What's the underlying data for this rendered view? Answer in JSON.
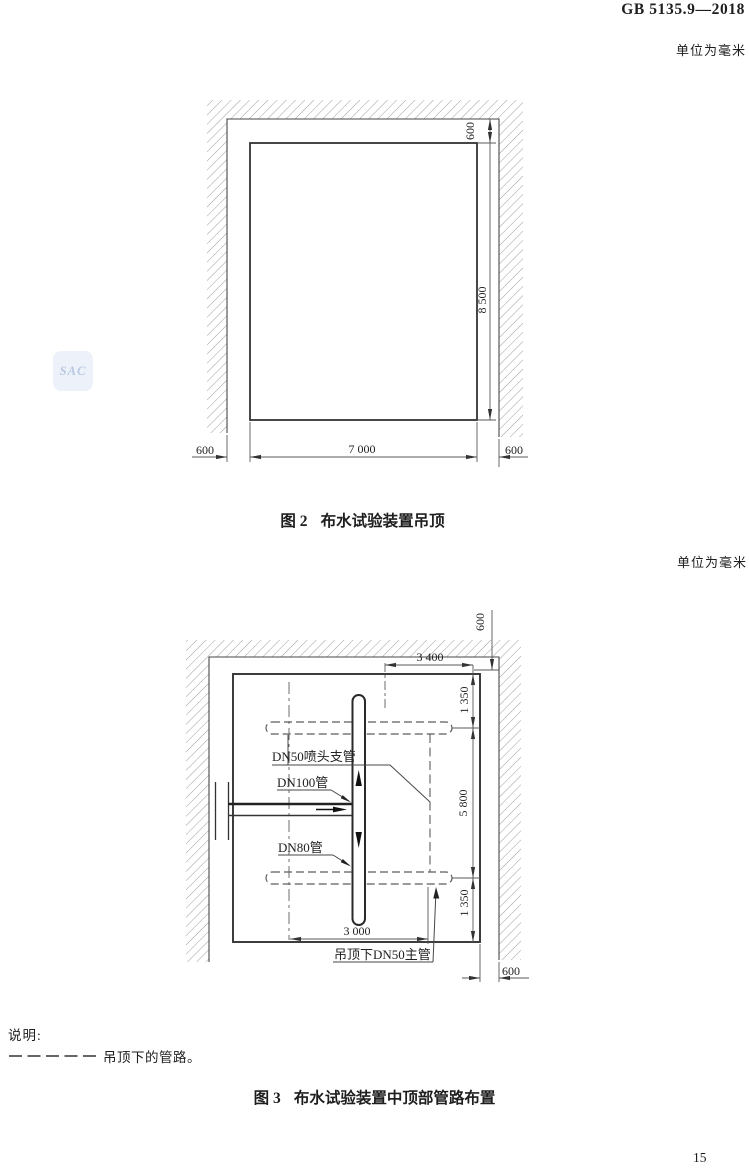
{
  "header": {
    "standard_code": "GB 5135.9—2018",
    "page_number": "15"
  },
  "units_note": "单位为毫米",
  "watermark_text": "SAC",
  "figure2": {
    "caption_prefix": "图 2",
    "caption_title": "布水试验装置吊顶",
    "dims": {
      "ceiling_top_offset": "600",
      "room_height": "8 500",
      "bottom_left_offset": "600",
      "room_width": "7 000",
      "bottom_right_offset": "600"
    }
  },
  "figure3": {
    "caption_prefix": "图 3",
    "caption_title": "布水试验装置中顶部管路布置",
    "labels": {
      "branch_pipe": "DN50喷头支管",
      "dn100_pipe": "DN100管",
      "dn80_pipe": "DN80管",
      "main_pipe": "吊顶下DN50主管"
    },
    "dims": {
      "ceiling_top_offset": "600",
      "branch_to_wall": "3 400",
      "top_spacing": "1 350",
      "branch_spacing": "5 800",
      "bottom_spacing": "1 350",
      "main_run": "3 000",
      "right_offset": "600"
    }
  },
  "legend": {
    "heading": "说明:",
    "dashed_meaning": "吊顶下的管路。"
  }
}
